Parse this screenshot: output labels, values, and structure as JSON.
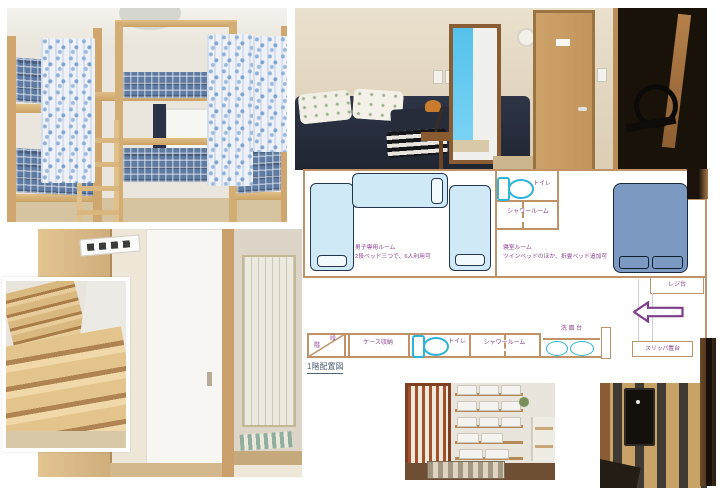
{
  "collage": {
    "photos": [
      {
        "name": "bunk-bed-dormitory-photo"
      },
      {
        "name": "bedroom-and-hallway-photo"
      },
      {
        "name": "staircase-photo"
      },
      {
        "name": "sliding-doors-hallway-photo"
      },
      {
        "name": "entrance-shoe-shelf-photo"
      },
      {
        "name": "lattice-door-photo"
      },
      {
        "name": "dark-door-edge-photo"
      }
    ]
  },
  "floor_plan": {
    "caption": "1階配置図",
    "dorm_room": {
      "name": "男子専用ルーム",
      "detail": "2段ベッド三つで、6人利用可"
    },
    "bedroom": {
      "name": "寝室ルーム",
      "detail": "ツインベッドのほか、折畳ベッド追加可"
    },
    "upper_toilet_label": "トイレ",
    "upper_shower_label": "シャワールーム",
    "lower_toilet_label": "トイレ",
    "lower_shower_label": "シャワールーム",
    "register_label": "レジ台",
    "slipper_label": "スリッパ置台",
    "washbasin_label": "洗 面 台",
    "stairs_char_1": "階",
    "stairs_char_2": "段",
    "case_storage_label": "ケース収納",
    "icons": [
      "toilet-icon",
      "washbasin-icon",
      "entrance-arrow-icon"
    ],
    "colors": {
      "wall": "#bf9267",
      "fixture_outline": "#2fb3d9",
      "label_text": "#8b3f8f",
      "bed_light": "#cfe9f6",
      "bed_dark": "#7b99c1",
      "arrow_outline": "#7e3d8c",
      "caption_text": "#4f6273"
    }
  }
}
